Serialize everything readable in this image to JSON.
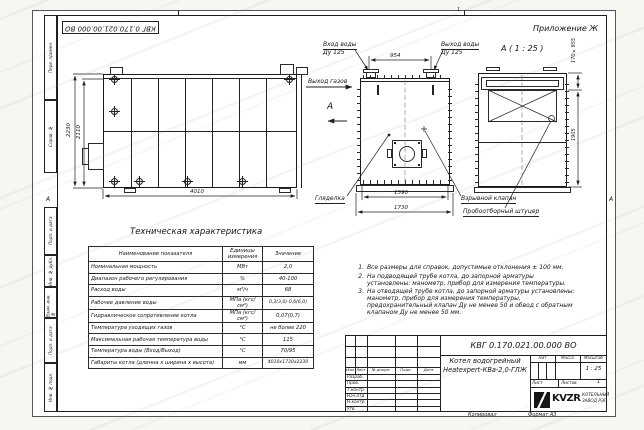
{
  "header": {
    "appendix": "Приложение Ж",
    "doc_number_top": "КВГ 0.170.021.00.000 ВО",
    "zone_top": "1",
    "zone_side_left": "А",
    "zone_side_right": "А"
  },
  "margin": {
    "top": [
      "Перв. примен.",
      "Справ. №"
    ],
    "bottom": [
      "Подп. и дата",
      "Инв. № дубл.",
      "Взам. инв. №",
      "Подп. и дата",
      "Инв. № подл."
    ]
  },
  "drawing": {
    "side": {
      "dim_height_outer": "2230",
      "dim_height_inner": "2110",
      "dim_length": "4010"
    },
    "front": {
      "water_in_line1": "Вход воды",
      "water_in_line2": "Ду 125",
      "water_out_line1": "Выход воды",
      "water_out_line2": "Ду 125",
      "gas_out": "Выход газов",
      "view_letter": "А",
      "dim_flanges": "954",
      "dim_body": "1590",
      "dim_base": "1730",
      "sight_glass": "Гляделка",
      "sampler": "Пробоотборный штуцер"
    },
    "viewA": {
      "caption": "А ( 1 : 25 )",
      "explosion_valve": "Взрывной клапан",
      "dim_duct": "170×955",
      "dim_height": "1905"
    }
  },
  "table": {
    "title": "Техническая характеристика",
    "headers": [
      "Наименование показателя",
      "Единицы измерения",
      "Значение"
    ],
    "rows": [
      [
        "Номинальная мощность",
        "МВт",
        "2,0"
      ],
      [
        "Диапазон рабочего регулирования",
        "%",
        "40-100"
      ],
      [
        "Расход воды",
        "м³/ч",
        "68"
      ],
      [
        "Рабочее давление воды",
        "МПа (кгс/см²)",
        "0,3(3,0)-0,6(6,0)"
      ],
      [
        "Гидравлическое сопротивление котла",
        "МПа (кгс/см²)",
        "0,07(0,7)"
      ],
      [
        "Температура уходящих газов",
        "°С",
        "не более 220"
      ],
      [
        "Максимальная рабочая температура воды",
        "°С",
        "115"
      ],
      [
        "Температура воды (Вход/Выход)",
        "°С",
        "70/95"
      ],
      [
        "Габариты котла (длинна х ширина х высота)",
        "мм",
        "4010х1730х2230"
      ]
    ]
  },
  "notes": {
    "items": [
      {
        "n": "1.",
        "t": "Все размеры для справок, допустимые отклонения ± 100 мм."
      },
      {
        "n": "2.",
        "t": "На подводящей трубе котла, до запорной арматуры установлены: манометр, прибор для измерения температуры."
      },
      {
        "n": "3.",
        "t": "На отводящей трубе котла, до запорной арматуры установлены: манометр, прибор для измерения температуры, предохранительный клапан Ду не менее 50 и обвод с обратным клапаном Ду не менее 50 мм."
      }
    ]
  },
  "title_block": {
    "doc_number": "КВГ 0.170.021.00.000 ВО",
    "product_line1": "Котел водогрейный",
    "product_line2": "Heatexpert-КВа-2,0-ГЛЖ",
    "header_cols": [
      "Изм",
      "Лист",
      "№ докум.",
      "Подп.",
      "Дата"
    ],
    "rows": [
      "Разраб.",
      "Пров.",
      "Т.контр.",
      "Нач.отд",
      "Н.контр.",
      "Утв."
    ],
    "lit_label": "Лит",
    "mass_label": "Масса",
    "scale_label": "Масштаб",
    "scale_value": "1 : 25",
    "sheet_label": "Лист",
    "sheets_label": "Листов",
    "sheets_value": "1",
    "logo_text": "KVZR",
    "logo_caption1": "КОТЕЛЬНЫЙ",
    "logo_caption2": "ЗАВОД РЭП",
    "copied_label": "Копировал",
    "format_label": "Формат А3"
  }
}
